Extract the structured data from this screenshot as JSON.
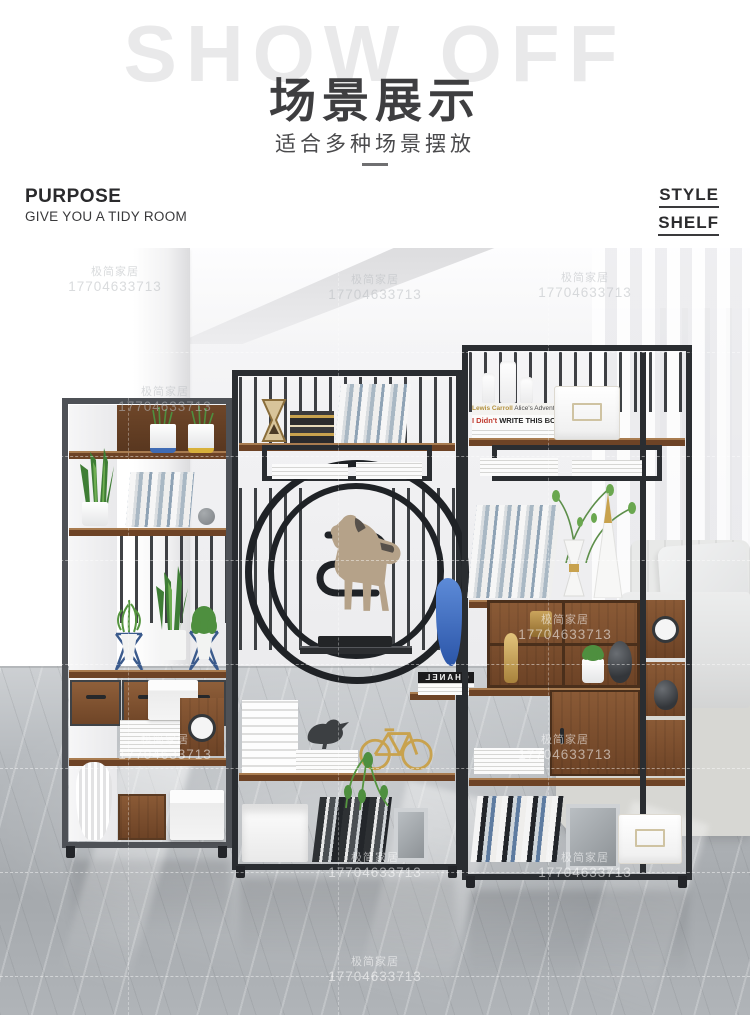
{
  "header": {
    "watermark_text": "SHOW OFF",
    "title": "场景展示",
    "subtitle": "适合多种场景摆放",
    "purpose": {
      "label": "PURPOSE",
      "sublabel": "GIVE YOU A TIDY ROOM"
    },
    "style": {
      "line1": "STYLE",
      "line2": "SHELF"
    }
  },
  "photo": {
    "watermark": {
      "brand": "极简家居",
      "phone": "17704633713"
    },
    "books": {
      "chanel": "CHANEL",
      "didnt_prefix": "I Didn't",
      "didnt_rest": " WRITE THIS BOOK",
      "alice_author": "Lewis Carroll",
      "alice_title": " Alice's Adventures in Wonderland"
    }
  },
  "colors": {
    "frame": "#2a2d31",
    "frame-gray": "#4e5156",
    "wood": "#8a5a36",
    "wood-dark": "#6d4326",
    "gold": "#c8a24e",
    "blue": "#3f6bb4",
    "green": "#4e8f3f",
    "sofa": "#e8e9e8",
    "floor": "#b2b6ba"
  }
}
